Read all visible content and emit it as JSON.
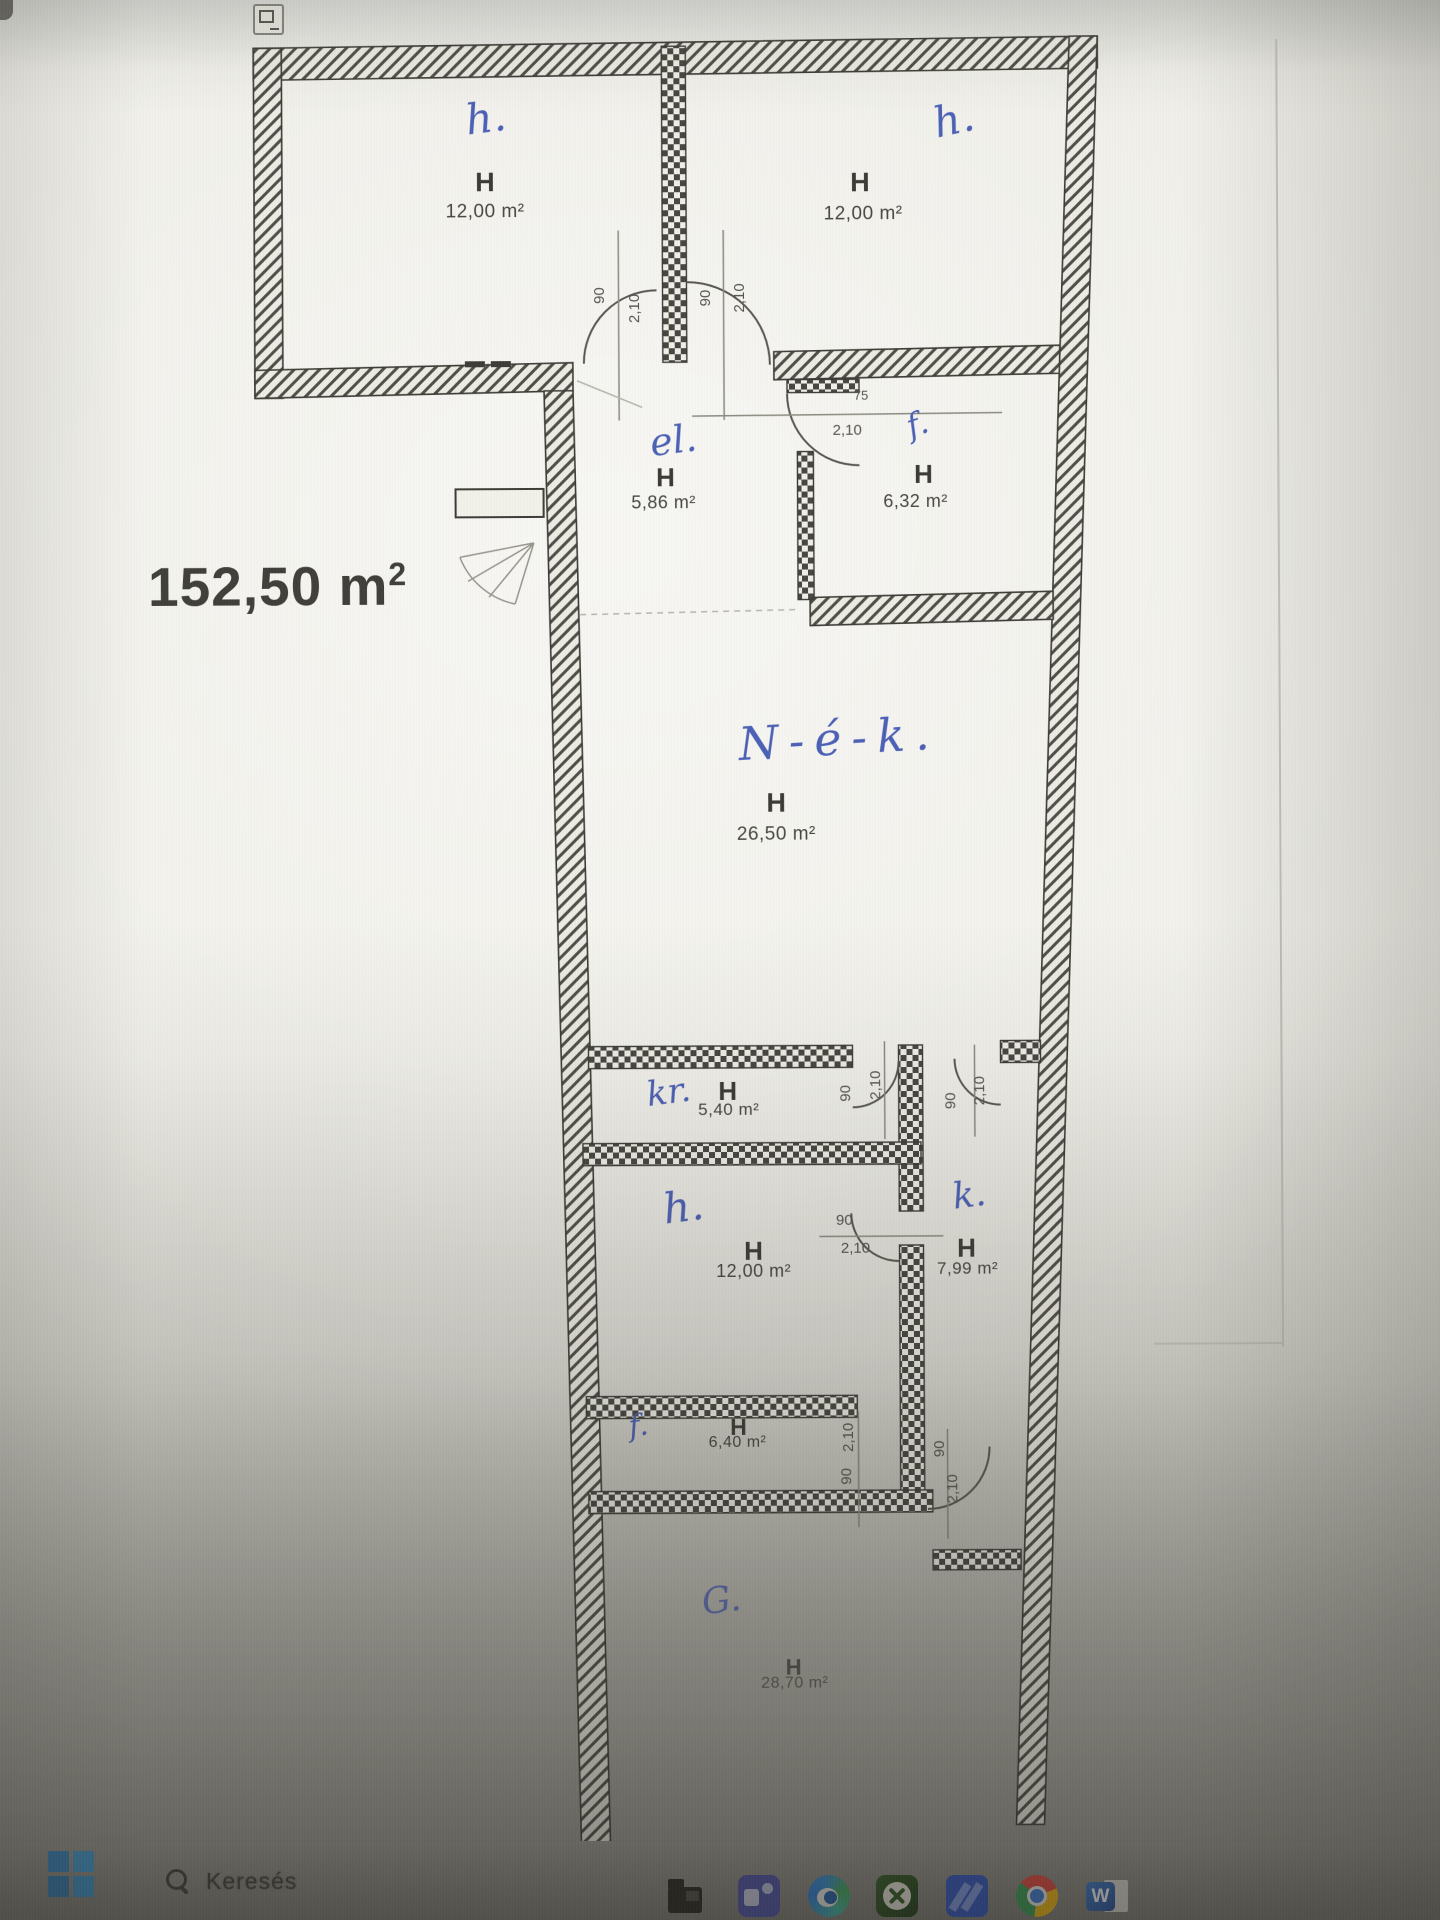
{
  "plan": {
    "total_area": {
      "value": "152,50 m",
      "sup": "2"
    },
    "rooms": [
      {
        "hand": "h.",
        "code": "H",
        "area": "12,00 m²"
      },
      {
        "hand": "h.",
        "code": "H",
        "area": "12,00 m²"
      },
      {
        "hand": "el.",
        "code": "H",
        "area": "5,86 m²"
      },
      {
        "hand": "f.",
        "code": "H",
        "area": "6,32 m²"
      },
      {
        "hand": "N-é-k.",
        "code": "H",
        "area": "26,50 m²"
      },
      {
        "hand": "kr.",
        "code": "H",
        "area": "5,40 m²"
      },
      {
        "hand": "h.",
        "code": "H",
        "area": "12,00 m²"
      },
      {
        "hand": "k.",
        "code": "H",
        "area": "7,99 m²"
      },
      {
        "hand": "f.",
        "code": "H",
        "area": "6,40 m²"
      },
      {
        "hand": "G.",
        "code": "H",
        "area": "28,70 m²"
      }
    ],
    "dims": [
      {
        "text": "90"
      },
      {
        "text": "2,10"
      },
      {
        "text": "90"
      },
      {
        "text": "2,10"
      },
      {
        "text": "75"
      },
      {
        "text": "2,10"
      },
      {
        "text": "90"
      },
      {
        "text": "2,10"
      },
      {
        "text": "90"
      },
      {
        "text": "2,10"
      },
      {
        "text": "90"
      },
      {
        "text": "2,10"
      },
      {
        "text": "2,10"
      },
      {
        "text": "90"
      },
      {
        "text": "90"
      },
      {
        "text": "2,10"
      }
    ]
  },
  "taskbar": {
    "search_label": "Keresés",
    "word_letter": "W",
    "icons": [
      "windows-start",
      "search",
      "file-explorer",
      "teams",
      "edge",
      "xbox",
      "blue-tiles",
      "chrome",
      "word"
    ]
  },
  "colors": {
    "ink": "#3b3a34",
    "hand_blue": "#4a5fb5",
    "paper": "#eeede6"
  }
}
